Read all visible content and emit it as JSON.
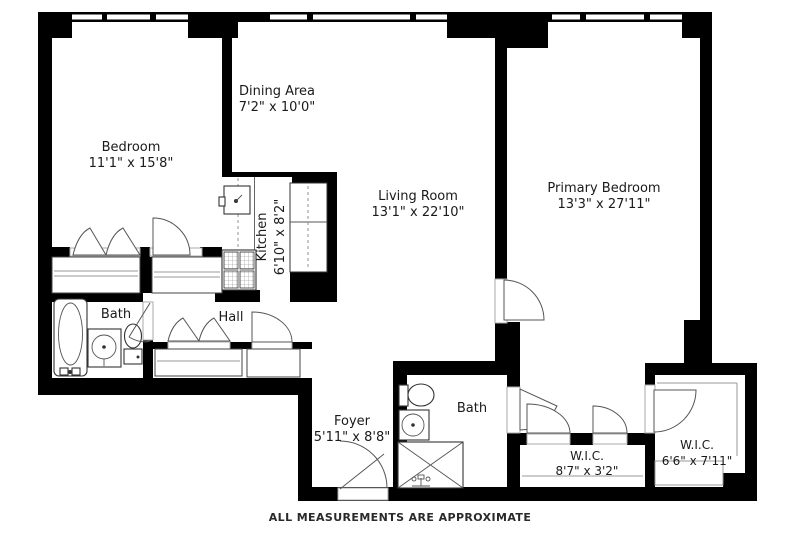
{
  "footer": {
    "disclaimer": "ALL MEASUREMENTS ARE APPROXIMATE"
  },
  "colors": {
    "wall": "#000000",
    "background": "#ffffff",
    "fixture_stroke": "#333333",
    "door_stroke": "#555555"
  },
  "rooms": {
    "bedroom": {
      "name": "Bedroom",
      "dims": "11'1\" x 15'8\""
    },
    "dining": {
      "name": "Dining Area",
      "dims": "7'2\" x 10'0\""
    },
    "living": {
      "name": "Living Room",
      "dims": "13'1\" x 22'10\""
    },
    "primary": {
      "name": "Primary Bedroom",
      "dims": "13'3\" x 27'11\""
    },
    "kitchen": {
      "name": "Kitchen",
      "dims": "6'10\" x 8'2\""
    },
    "foyer": {
      "name": "Foyer",
      "dims": "5'11\" x 8'8\""
    },
    "hall": {
      "name": "Hall"
    },
    "bath_left": {
      "name": "Bath"
    },
    "bath_main": {
      "name": "Bath"
    },
    "wic_small": {
      "name": "W.I.C.",
      "dims": "8'7\" x 3'2\""
    },
    "wic_large": {
      "name": "W.I.C.",
      "dims": "6'6\" x 7'11\""
    }
  }
}
